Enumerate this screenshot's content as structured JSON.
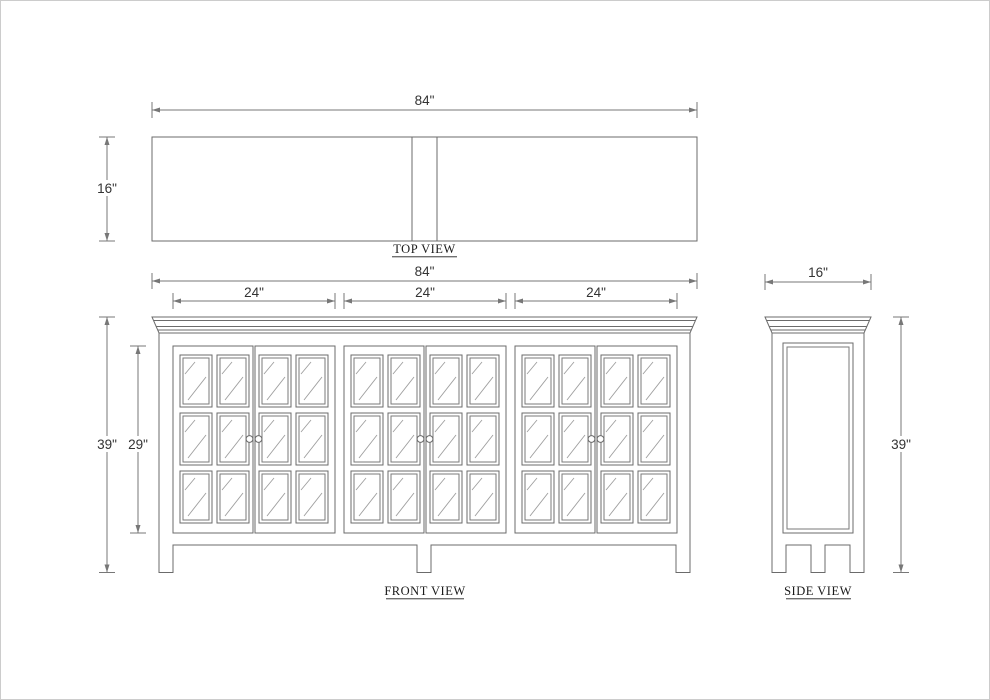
{
  "page": {
    "background": "#ffffff",
    "border_color": "#cccccc"
  },
  "drawing": {
    "line_color": "#6b6b6b",
    "dimension_color": "#777777",
    "glass_line_color": "#9e9e9e",
    "text_color": "#333333",
    "views": {
      "top": {
        "label": "TOP VIEW",
        "width_dim": "84\"",
        "depth_dim": "16\""
      },
      "front": {
        "label": "FRONT VIEW",
        "width_dim": "84\"",
        "section_dims": [
          "24\"",
          "24\"",
          "24\""
        ],
        "height_dim": "39\"",
        "door_height_dim": "29\""
      },
      "side": {
        "label": "SIDE VIEW",
        "depth_dim": "16\"",
        "height_dim": "39\""
      }
    }
  }
}
